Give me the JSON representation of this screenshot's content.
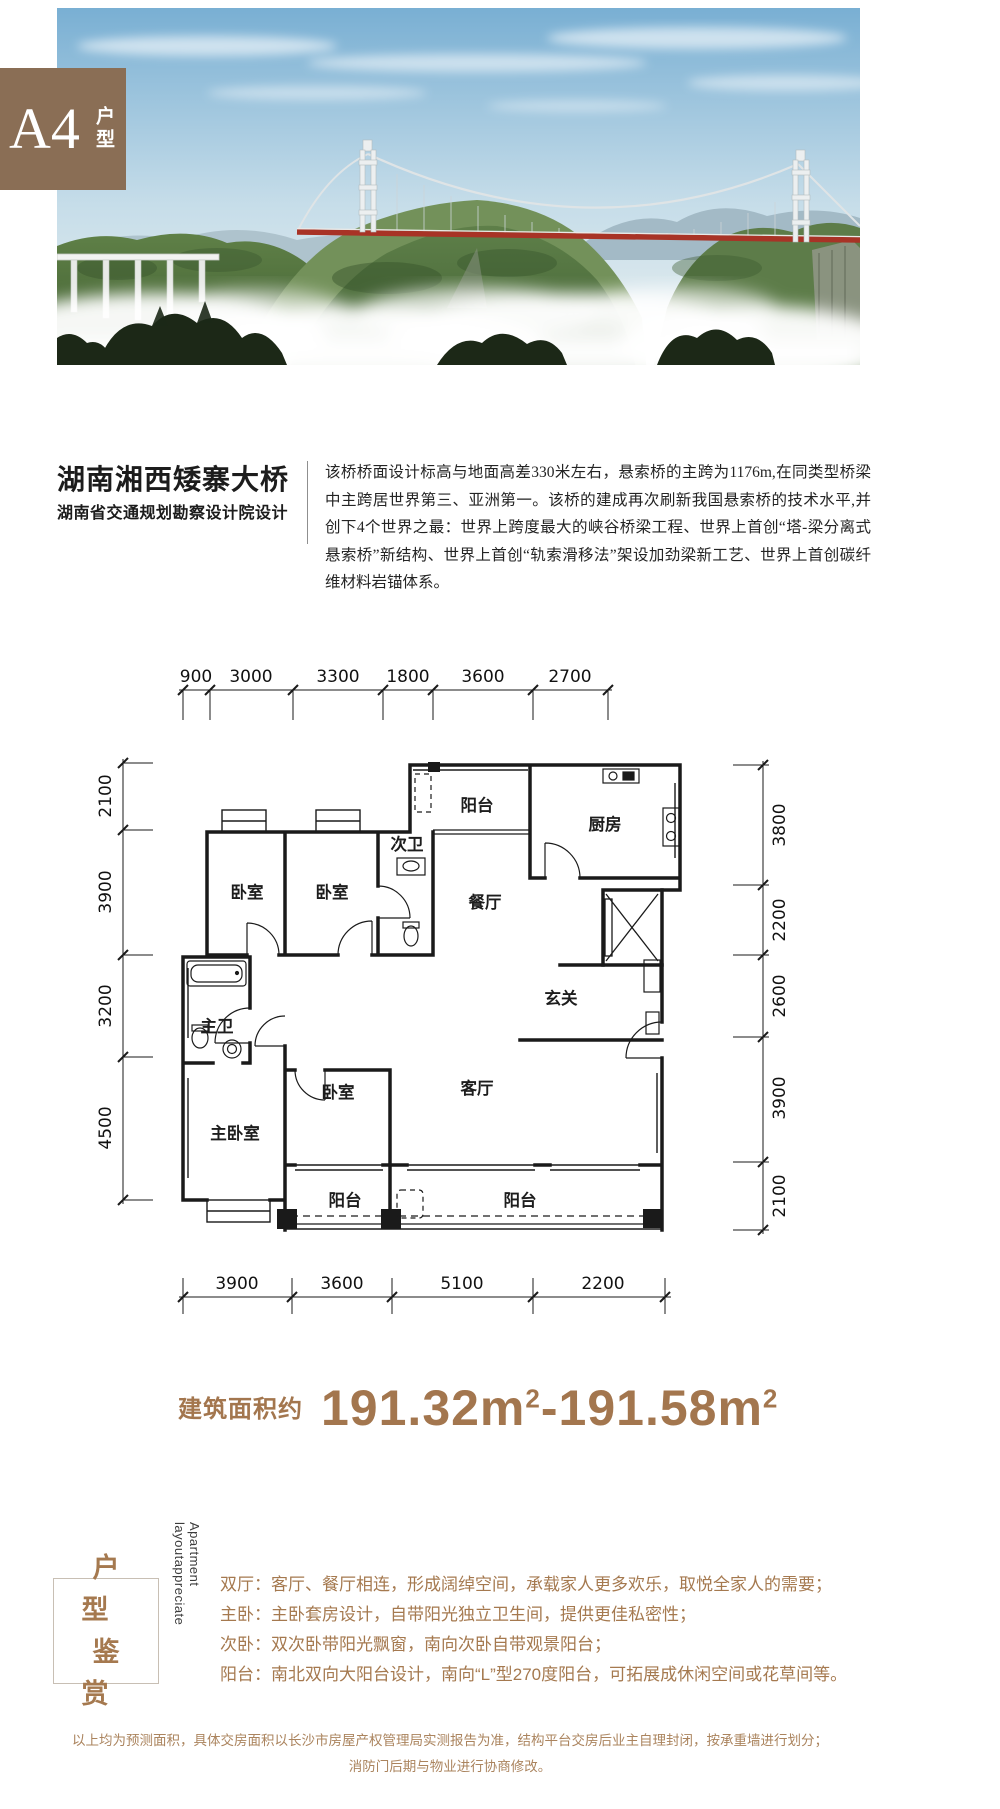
{
  "badge": {
    "code": "A4",
    "type": "户型",
    "bg_color": "#8a6e55"
  },
  "bridge_info": {
    "title": "湖南湘西矮寨大桥",
    "subtitle": "湖南省交通规划勘察设计院设计",
    "paragraph": "该桥桥面设计标高与地面高差330米左右，悬索桥的主跨为1176m,在同类型桥梁中主跨居世界第三、亚洲第一。该桥的建成再次刷新我国悬索桥的技术水平,并创下4个世界之最：世界上跨度最大的峡谷桥梁工程、世界上首创“塔-梁分离式悬索桥”新结构、世界上首创“轨索滑移法”架设加劲梁新工艺、世界上首创碳纤维材料岩锚体系。"
  },
  "floorplan": {
    "dims_top": [
      "900",
      "3000",
      "3300",
      "1800",
      "3600",
      "2700"
    ],
    "dims_left": [
      "2100",
      "3900",
      "3200",
      "4500"
    ],
    "dims_right": [
      "3800",
      "2200",
      "2600",
      "3900",
      "2100"
    ],
    "dims_bottom": [
      "3900",
      "3600",
      "5100",
      "2200"
    ],
    "rooms": [
      {
        "label": "阳台"
      },
      {
        "label": "厨房"
      },
      {
        "label": "次卫"
      },
      {
        "label": "餐厅"
      },
      {
        "label": "卧室"
      },
      {
        "label": "卧室"
      },
      {
        "label": "主卫"
      },
      {
        "label": "玄关"
      },
      {
        "label": "主卧室"
      },
      {
        "label": "卧室"
      },
      {
        "label": "客厅"
      },
      {
        "label": "阳台"
      },
      {
        "label": "阳台"
      }
    ]
  },
  "area": {
    "label": "建筑面积约",
    "value1": "191.32m",
    "sup1": "2",
    "dash": "-",
    "value2": "191.58m",
    "sup2": "2",
    "color": "#a3764e"
  },
  "appreciation": {
    "box_line1": "户型",
    "box_line2": "鉴赏",
    "side_text": "Apartment layoutappreciate",
    "items": [
      {
        "label": "双厅：",
        "text": "客厅、餐厅相连，形成阔绰空间，承载家人更多欢乐，取悦全家人的需要；"
      },
      {
        "label": "主卧：",
        "text": "主卧套房设计，自带阳光独立卫生间，提供更佳私密性；"
      },
      {
        "label": "次卧：",
        "text": "双次卧带阳光飘窗，南向次卧自带观景阳台；"
      },
      {
        "label": "阳台：",
        "text": "南北双向大阳台设计，南向“L”型270度阳台，可拓展成休闲空间或花草间等。"
      }
    ]
  },
  "disclaimer": {
    "line1": "以上均为预测面积，具体交房面积以长沙市房屋产权管理局实测报告为准，结构平台交房后业主自理封闭，按承重墙进行划分；",
    "line2": "消防门后期与物业进行协商修改。"
  }
}
